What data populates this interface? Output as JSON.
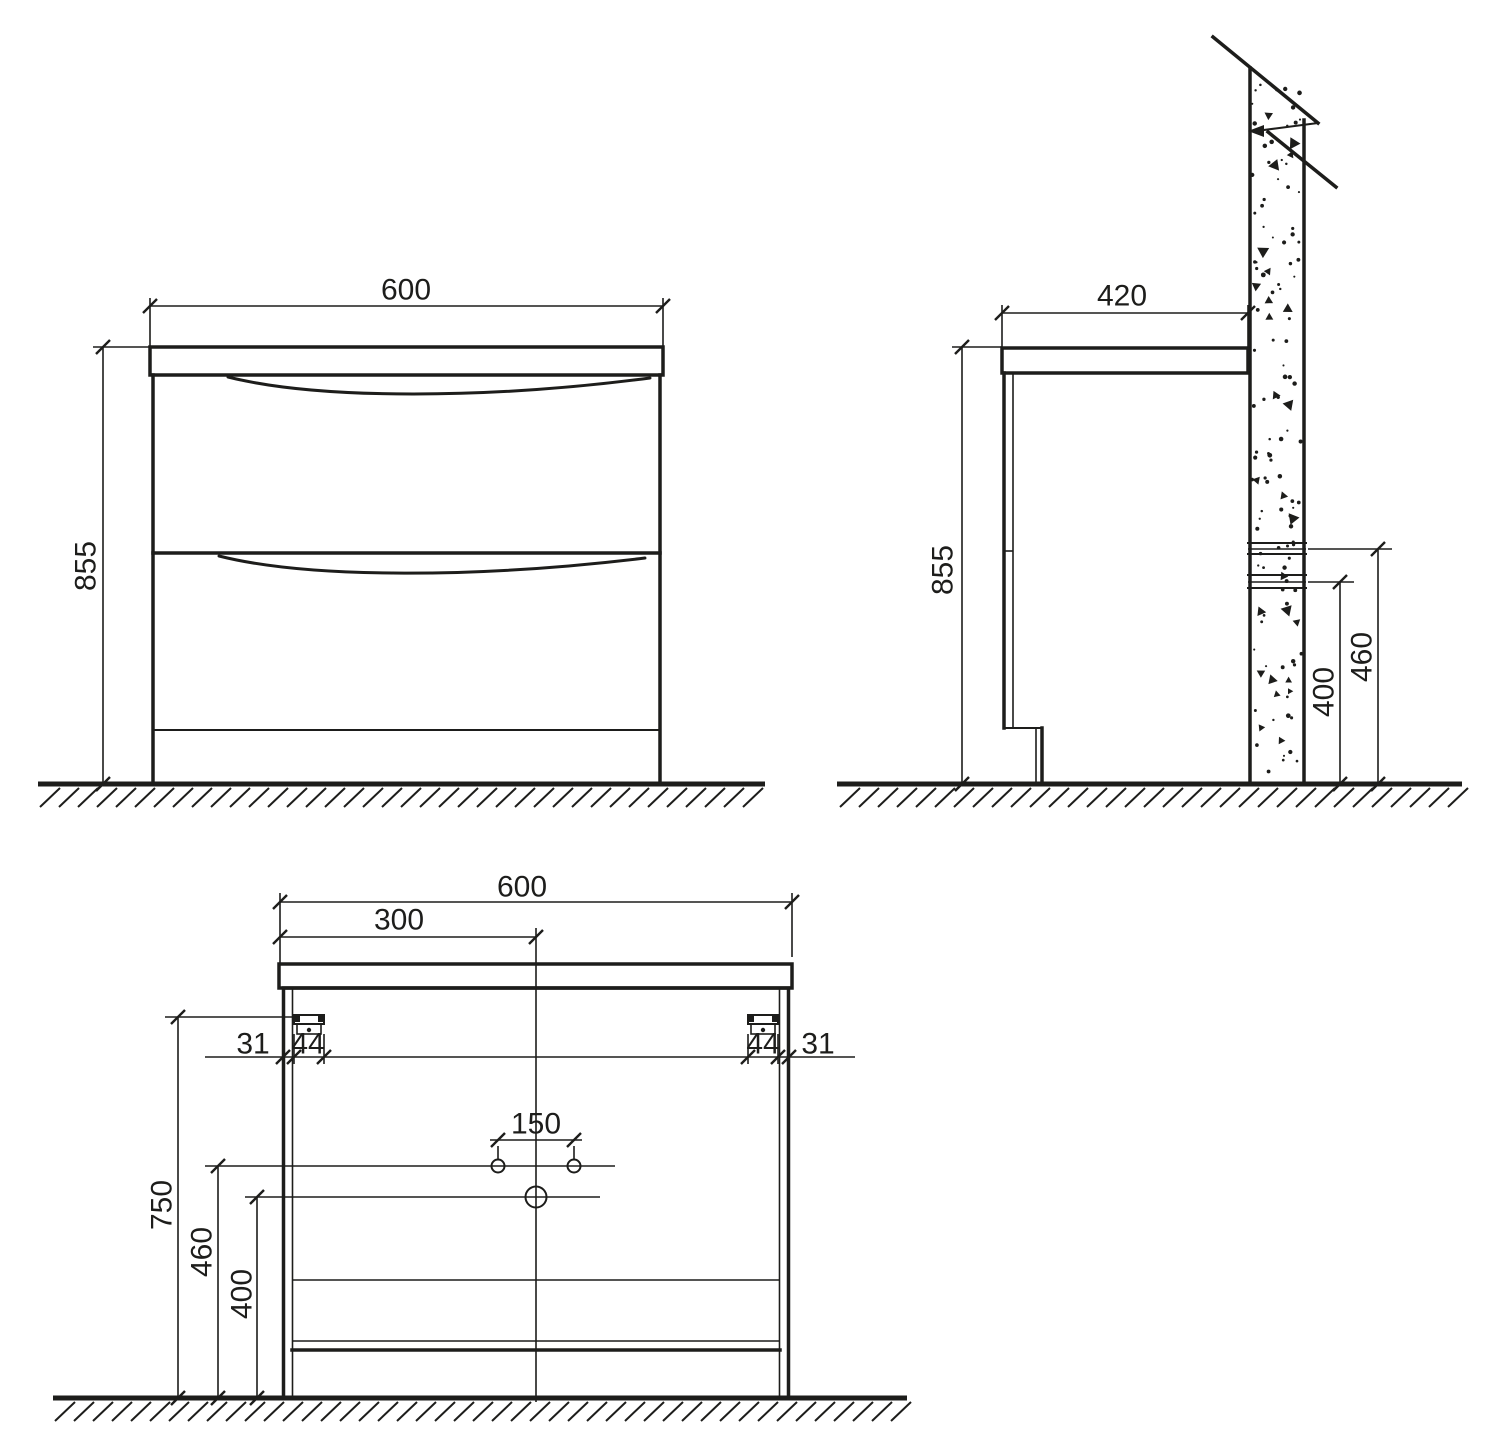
{
  "drawing": {
    "line_color": "#1d1d1b",
    "background": "#ffffff"
  },
  "front_view": {
    "width_mm": "600",
    "height_mm": "855"
  },
  "side_view": {
    "depth_mm": "420",
    "height_mm": "855",
    "upper_outlet_height_mm": "460",
    "lower_outlet_height_mm": "400"
  },
  "back_view": {
    "width_mm": "600",
    "center_offset_mm": "300",
    "left_edge_gap_mm": "31",
    "left_bracket_width_mm": "44",
    "right_bracket_width_mm": "44",
    "right_edge_gap_mm": "31",
    "faucet_hole_spacing_mm": "150",
    "bracket_height_mm": "750",
    "supply_height_mm": "460",
    "drain_height_mm": "400"
  }
}
